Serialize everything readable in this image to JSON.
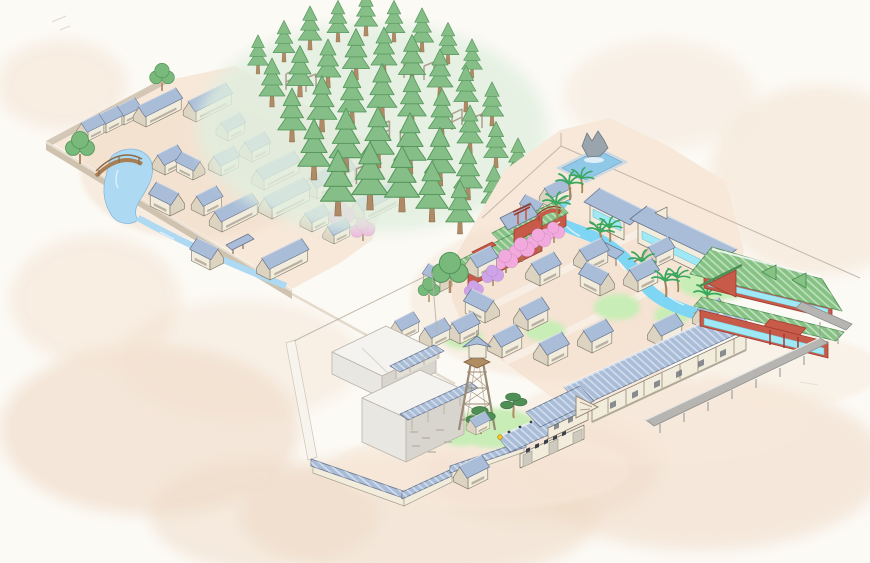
{
  "meta": {
    "description": "Hand-drawn isometric watercolor map of a Japanese movie-village theme park: walled old village with pond and arched bridge, cedar forest with wooden climbing frames, town grid with canal and palm trees, red teahouse street with cherry blossoms, grand inn, vermilion pavilion with green roofs, sound stages, fire watchtower, palace gate and tiled walls"
  },
  "palette": {
    "bg": "#fcfaf5",
    "washA": "#f0dcc9",
    "washB": "#eedac6",
    "washC": "#f3e2d0",
    "forestWash": "#e0efdf",
    "ground": "#f7e8d9",
    "street": "#f9f0e5",
    "wallTan": "#cfc2af",
    "wallTanTop": "#eae1d2",
    "waterL": "#aed9f2",
    "water": "#7fd6f4",
    "pool": "#90c9e8",
    "roofB": "#a9bdd8",
    "roofS": "#67748f",
    "roofG": "#85c283",
    "roofGS": "#4e8f54",
    "red": "#c75a48",
    "redD": "#9e3c2e",
    "wallC": "#f2ecdd",
    "wallD": "#ddd3c1",
    "winD": "#8d8271",
    "ink": "#7c7466",
    "timber": "#9b8a74",
    "trunk": "#b08a64",
    "conif": "#85bf87",
    "conifD": "#58985e",
    "leaf": "#7ab97c",
    "leafD": "#4f9457",
    "pine": "#4f8f55",
    "palm": "#3aa85e",
    "cherry": "#f2aade",
    "cherry2": "#cfa3e8",
    "lawn": "#c8edb6",
    "gold": "#f2c230",
    "walk": "#b6b5b2",
    "stageTop": "#f4f3ef",
    "stageL": "#e9e7e2",
    "stageR": "#d8d5cf",
    "cyan": "#9fe8f5",
    "stone": "#cfcabf",
    "fence": "#b8b0a2"
  },
  "scene": {
    "layers": {
      "nw": [
        {
          "t": "house",
          "x": 88,
          "y": 141,
          "s": 0.72
        },
        {
          "t": "house",
          "x": 106,
          "y": 133,
          "s": 0.72
        },
        {
          "t": "house",
          "x": 124,
          "y": 125,
          "s": 0.72
        },
        {
          "t": "houseL",
          "x": 146,
          "y": 127,
          "s": 0.8
        },
        {
          "t": "houseL",
          "x": 196,
          "y": 122,
          "s": 0.8
        },
        {
          "t": "house",
          "x": 228,
          "y": 141,
          "s": 0.75
        },
        {
          "t": "house",
          "x": 165,
          "y": 175,
          "s": 0.8
        },
        {
          "t": "house",
          "x": 193,
          "y": 180,
          "s": 0.75,
          "f": 1
        },
        {
          "t": "house",
          "x": 221,
          "y": 176,
          "s": 0.8
        },
        {
          "t": "house",
          "x": 252,
          "y": 162,
          "s": 0.8
        },
        {
          "t": "houseL",
          "x": 264,
          "y": 190,
          "s": 0.8
        },
        {
          "t": "house",
          "x": 170,
          "y": 216,
          "s": 0.9,
          "f": 1
        },
        {
          "t": "house",
          "x": 204,
          "y": 216,
          "s": 0.8
        },
        {
          "t": "houseL",
          "x": 222,
          "y": 232,
          "s": 0.8
        },
        {
          "t": "houseL",
          "x": 272,
          "y": 219,
          "s": 0.85
        },
        {
          "t": "houseL",
          "x": 317,
          "y": 199,
          "s": 0.85
        },
        {
          "t": "houseL",
          "x": 364,
          "y": 222,
          "s": 0.85
        },
        {
          "t": "house",
          "x": 312,
          "y": 232,
          "s": 0.75
        },
        {
          "t": "house",
          "x": 334,
          "y": 244,
          "s": 0.7
        },
        {
          "t": "house",
          "x": 210,
          "y": 270,
          "s": 0.85,
          "f": 1
        },
        {
          "t": "houseL",
          "x": 270,
          "y": 280,
          "s": 0.85
        },
        {
          "t": "tree",
          "x": 80,
          "y": 164,
          "s": 1
        },
        {
          "t": "tree",
          "x": 162,
          "y": 91,
          "s": 0.85
        },
        {
          "t": "cherry",
          "x": 342,
          "y": 228,
          "s": 1.1
        },
        {
          "t": "cherry",
          "x": 363,
          "y": 241,
          "s": 1
        }
      ],
      "forest": [
        {
          "t": "conifer",
          "x": 258,
          "y": 74,
          "s": 0.8
        },
        {
          "t": "conifer",
          "x": 284,
          "y": 62,
          "s": 0.85
        },
        {
          "t": "conifer",
          "x": 310,
          "y": 50,
          "s": 0.9
        },
        {
          "t": "conifer",
          "x": 338,
          "y": 42,
          "s": 0.85
        },
        {
          "t": "conifer",
          "x": 366,
          "y": 36,
          "s": 0.9
        },
        {
          "t": "conifer",
          "x": 394,
          "y": 42,
          "s": 0.85
        },
        {
          "t": "conifer",
          "x": 422,
          "y": 52,
          "s": 0.9
        },
        {
          "t": "conifer",
          "x": 448,
          "y": 64,
          "s": 0.85
        },
        {
          "t": "conifer",
          "x": 472,
          "y": 78,
          "s": 0.8
        },
        {
          "t": "conifer",
          "x": 272,
          "y": 107,
          "s": 1.0
        },
        {
          "t": "conifer",
          "x": 300,
          "y": 97,
          "s": 1.05
        },
        {
          "t": "conifer",
          "x": 328,
          "y": 88,
          "s": 1.0
        },
        {
          "t": "conifer",
          "x": 356,
          "y": 80,
          "s": 1.05
        },
        {
          "t": "conifer",
          "x": 384,
          "y": 76,
          "s": 1.0
        },
        {
          "t": "conifer",
          "x": 412,
          "y": 86,
          "s": 1.05
        },
        {
          "t": "conifer",
          "x": 440,
          "y": 98,
          "s": 1.0
        },
        {
          "t": "conifer",
          "x": 466,
          "y": 112,
          "s": 0.95
        },
        {
          "t": "conifer",
          "x": 492,
          "y": 126,
          "s": 0.9
        },
        {
          "t": "frame",
          "x": 302,
          "y": 90,
          "s": 1
        },
        {
          "t": "frame",
          "x": 420,
          "y": 78,
          "s": 1
        },
        {
          "t": "frame",
          "x": 396,
          "y": 144,
          "s": 1.1
        },
        {
          "t": "frame",
          "x": 468,
          "y": 130,
          "s": 1
        },
        {
          "t": "frame",
          "x": 352,
          "y": 182,
          "s": 1.1
        },
        {
          "t": "conifer",
          "x": 292,
          "y": 142,
          "s": 1.1
        },
        {
          "t": "conifer",
          "x": 322,
          "y": 132,
          "s": 1.15
        },
        {
          "t": "conifer",
          "x": 352,
          "y": 124,
          "s": 1.1
        },
        {
          "t": "conifer",
          "x": 382,
          "y": 120,
          "s": 1.15
        },
        {
          "t": "conifer",
          "x": 412,
          "y": 128,
          "s": 1.1
        },
        {
          "t": "conifer",
          "x": 442,
          "y": 140,
          "s": 1.05
        },
        {
          "t": "conifer",
          "x": 470,
          "y": 154,
          "s": 1.0
        },
        {
          "t": "conifer",
          "x": 496,
          "y": 168,
          "s": 0.95
        },
        {
          "t": "conifer",
          "x": 518,
          "y": 182,
          "s": 0.9
        },
        {
          "t": "conifer",
          "x": 314,
          "y": 180,
          "s": 1.25
        },
        {
          "t": "conifer",
          "x": 346,
          "y": 172,
          "s": 1.3
        },
        {
          "t": "conifer",
          "x": 378,
          "y": 168,
          "s": 1.25
        },
        {
          "t": "conifer",
          "x": 410,
          "y": 174,
          "s": 1.25
        },
        {
          "t": "conifer",
          "x": 440,
          "y": 186,
          "s": 1.2
        },
        {
          "t": "conifer",
          "x": 468,
          "y": 200,
          "s": 1.1
        },
        {
          "t": "conifer",
          "x": 494,
          "y": 214,
          "s": 1.0
        },
        {
          "t": "conifer",
          "x": 338,
          "y": 216,
          "s": 1.35
        },
        {
          "t": "conifer",
          "x": 370,
          "y": 210,
          "s": 1.4
        },
        {
          "t": "conifer",
          "x": 402,
          "y": 212,
          "s": 1.35
        },
        {
          "t": "conifer",
          "x": 432,
          "y": 222,
          "s": 1.25
        },
        {
          "t": "conifer",
          "x": 460,
          "y": 234,
          "s": 1.1
        }
      ],
      "mid": [
        {
          "t": "house",
          "x": 552,
          "y": 208,
          "s": 0.8
        },
        {
          "t": "house",
          "x": 536,
          "y": 221,
          "s": 0.7,
          "f": 1
        }
      ],
      "town": [
        {
          "t": "palm",
          "x": 570,
          "y": 200,
          "s": 1
        },
        {
          "t": "palm",
          "x": 582,
          "y": 193,
          "s": 0.9
        },
        {
          "t": "palm",
          "x": 557,
          "y": 220,
          "s": 1
        },
        {
          "t": "palm",
          "x": 601,
          "y": 248,
          "s": 1
        },
        {
          "t": "palm",
          "x": 610,
          "y": 242,
          "s": 0.9
        },
        {
          "t": "palm",
          "x": 643,
          "y": 278,
          "s": 1
        },
        {
          "t": "palm",
          "x": 666,
          "y": 297,
          "s": 1
        },
        {
          "t": "palm",
          "x": 678,
          "y": 292,
          "s": 0.9
        },
        {
          "t": "palm",
          "x": 708,
          "y": 311,
          "s": 1
        },
        {
          "t": "cherry",
          "x": 506,
          "y": 273,
          "s": 1
        },
        {
          "t": "cherry",
          "x": 522,
          "y": 262,
          "s": 1.05
        },
        {
          "t": "cherry",
          "x": 539,
          "y": 252,
          "s": 1
        },
        {
          "t": "cherry",
          "x": 554,
          "y": 243,
          "s": 0.9
        },
        {
          "t": "cherry2",
          "x": 493,
          "y": 286,
          "s": 0.9
        },
        {
          "t": "cherry2",
          "x": 474,
          "y": 299,
          "s": 0.8
        },
        {
          "t": "tree",
          "x": 450,
          "y": 293,
          "s": 1.25
        },
        {
          "t": "tree",
          "x": 429,
          "y": 302,
          "s": 0.75
        },
        {
          "t": "house",
          "x": 478,
          "y": 278,
          "s": 0.85
        },
        {
          "t": "house",
          "x": 540,
          "y": 286,
          "s": 0.9
        },
        {
          "t": "house",
          "x": 588,
          "y": 272,
          "s": 0.9
        },
        {
          "t": "house",
          "x": 600,
          "y": 296,
          "s": 0.9,
          "f": 1
        },
        {
          "t": "house",
          "x": 638,
          "y": 292,
          "s": 0.9
        },
        {
          "t": "house",
          "x": 656,
          "y": 267,
          "s": 0.8
        },
        {
          "t": "house",
          "x": 440,
          "y": 292,
          "s": 0.75,
          "f": 1
        },
        {
          "t": "house",
          "x": 485,
          "y": 323,
          "s": 0.9,
          "f": 1
        },
        {
          "t": "house",
          "x": 528,
          "y": 331,
          "s": 0.9
        },
        {
          "t": "house",
          "x": 460,
          "y": 344,
          "s": 0.85
        },
        {
          "t": "house",
          "x": 432,
          "y": 348,
          "s": 0.8
        },
        {
          "t": "house",
          "x": 402,
          "y": 340,
          "s": 0.75
        },
        {
          "t": "house",
          "x": 502,
          "y": 358,
          "s": 0.9
        },
        {
          "t": "house",
          "x": 548,
          "y": 366,
          "s": 0.9
        },
        {
          "t": "house",
          "x": 592,
          "y": 353,
          "s": 0.9
        }
      ],
      "south": [
        {
          "t": "house",
          "x": 662,
          "y": 347,
          "s": 0.9
        },
        {
          "t": "house",
          "x": 706,
          "y": 330,
          "s": 0.85
        },
        {
          "t": "pine",
          "x": 481,
          "y": 434,
          "s": 1.1
        },
        {
          "t": "pine",
          "x": 514,
          "y": 418,
          "s": 1
        },
        {
          "t": "pine",
          "x": 528,
          "y": 442,
          "s": 0.6
        },
        {
          "t": "house",
          "x": 468,
          "y": 489,
          "s": 0.9
        }
      ]
    }
  }
}
